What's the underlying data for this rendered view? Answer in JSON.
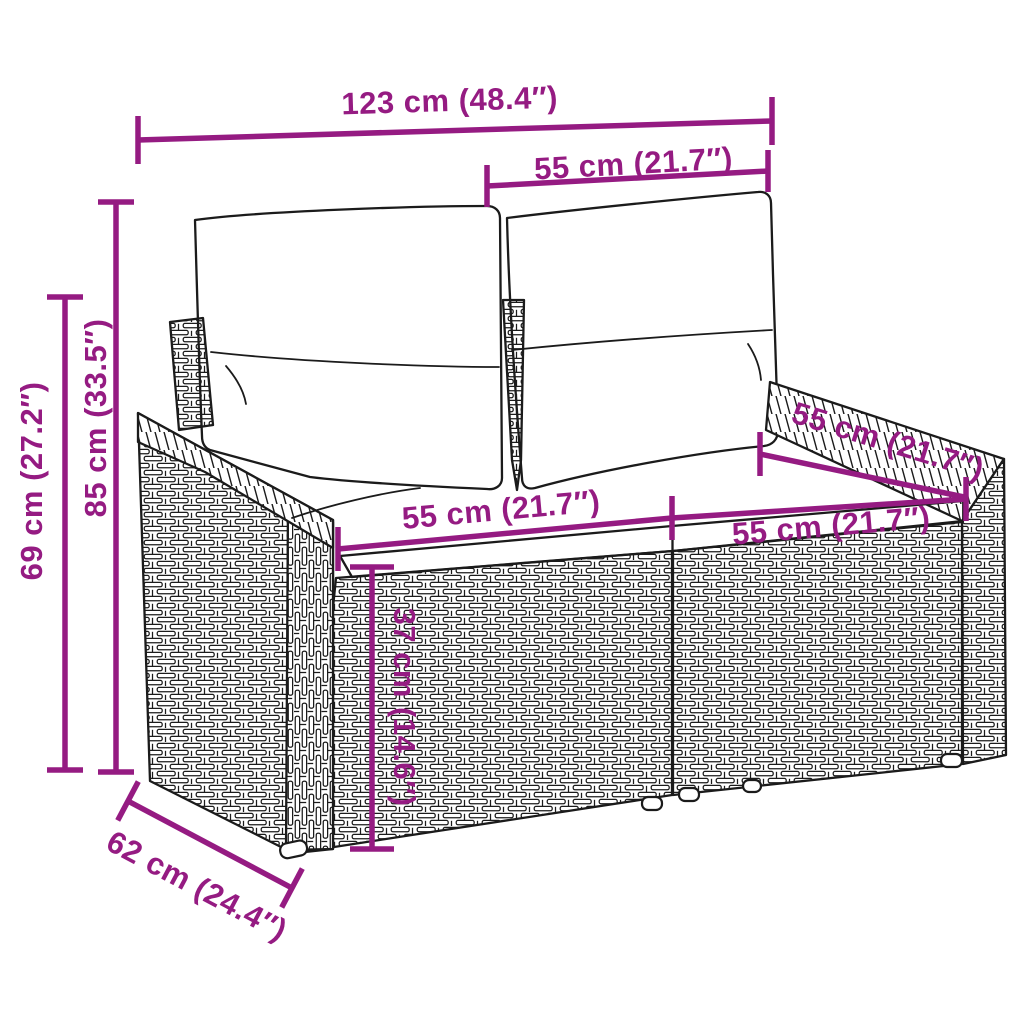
{
  "colors": {
    "dimension_accent": "#951b82",
    "line_art": "#1b1b1b",
    "background": "#ffffff"
  },
  "dimensions": {
    "overall_width": "123 cm (48.4″)",
    "backrest_cushion_width": "55 cm (21.7″)",
    "overall_height": "85 cm (33.5″)",
    "armrest_height": "69 cm (27.2″)",
    "seat_left_width": "55 cm (21.7″)",
    "seat_right_width": "55 cm (21.7″)",
    "seat_depth": "55 cm (21.7″)",
    "seat_front_height": "37 cm (14.6″)",
    "overall_depth": "62 cm (24.4″)"
  }
}
